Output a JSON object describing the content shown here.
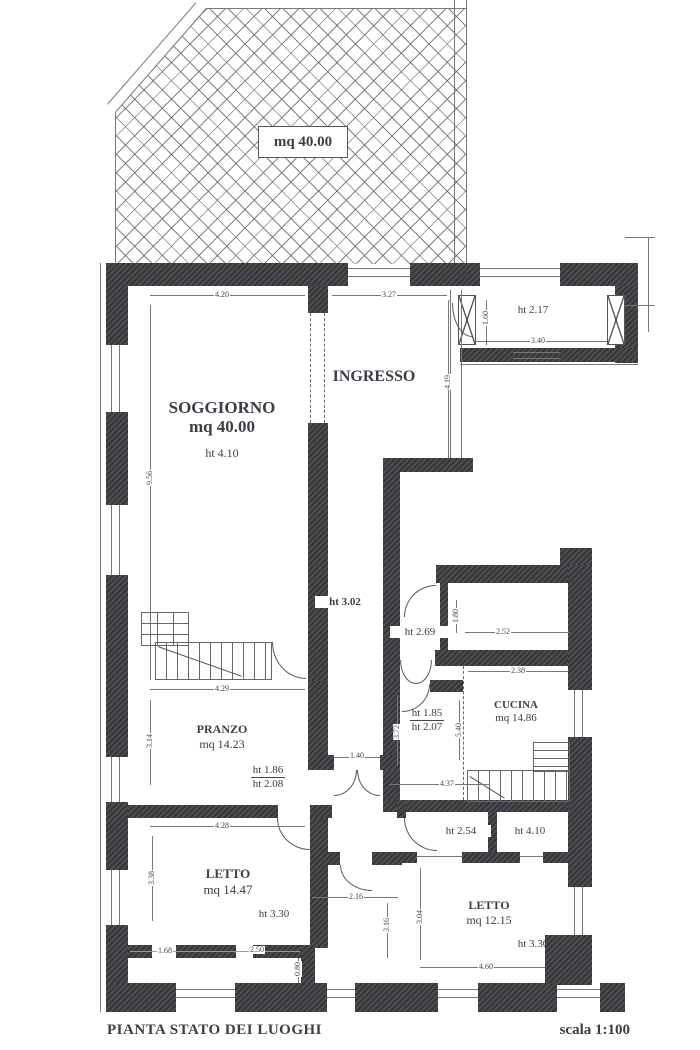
{
  "terrace": {
    "area_label": "mq 40.00"
  },
  "rooms": {
    "soggiorno": {
      "name": "SOGGIORNO",
      "area": "mq 40.00",
      "height": "ht 4.10"
    },
    "ingresso": {
      "name": "INGRESSO"
    },
    "veranda": {
      "height": "ht 2.17"
    },
    "corridoio": {
      "height": "ht 3.02"
    },
    "wc": {
      "height": "ht 2.69"
    },
    "bagno": {
      "height_upper": "ht 1.85",
      "height_lower": "ht 2.07"
    },
    "cucina": {
      "name": "CUCINA",
      "area": "mq 14.86"
    },
    "pranzo": {
      "name": "PRANZO",
      "area": "mq 14.23",
      "height_upper": "ht 1.86",
      "height_lower": "ht 2.08"
    },
    "letto_sx": {
      "name": "LETTO",
      "area": "mq 14.47",
      "height": "ht 3.30"
    },
    "disimpegno": {
      "height": "ht 2.54"
    },
    "vano_dx": {
      "height": "ht 4.10"
    },
    "letto_dx": {
      "name": "LETTO",
      "area": "mq 12.15",
      "height": "ht 3.30"
    }
  },
  "dims": {
    "soggiorno_w": "4.20",
    "ingresso_w": "3.27",
    "veranda_h": "1.60",
    "veranda_w": "3.40",
    "soggiorno_h": "9.56",
    "ingresso_h": "4.19",
    "wc_h": "1.80",
    "wc_w": "2.52",
    "cucina_w": "2.38",
    "cucina_h": "5.40",
    "pranzo_w": "4.29",
    "pranzo_h": "3.14",
    "hall_door_w": "1.40",
    "bagno_h": "3.72",
    "bagno_w": "4.37",
    "letto_sx_w": "4.28",
    "letto_sx_h": "3.38",
    "mid_w": "2.16",
    "mid_h": "3.16",
    "letto_dx_h": "3.04",
    "seg_a": "1.68",
    "seg_b": "2.50",
    "seg_c": "0.80",
    "letto_dx_w": "4.60"
  },
  "footer": {
    "title": "PIANTA STATO DEI LUOGHI",
    "scale": "scala 1:100"
  },
  "colors": {
    "wall": "#3f3f43",
    "line": "#777777",
    "text": "#3d3d46"
  }
}
